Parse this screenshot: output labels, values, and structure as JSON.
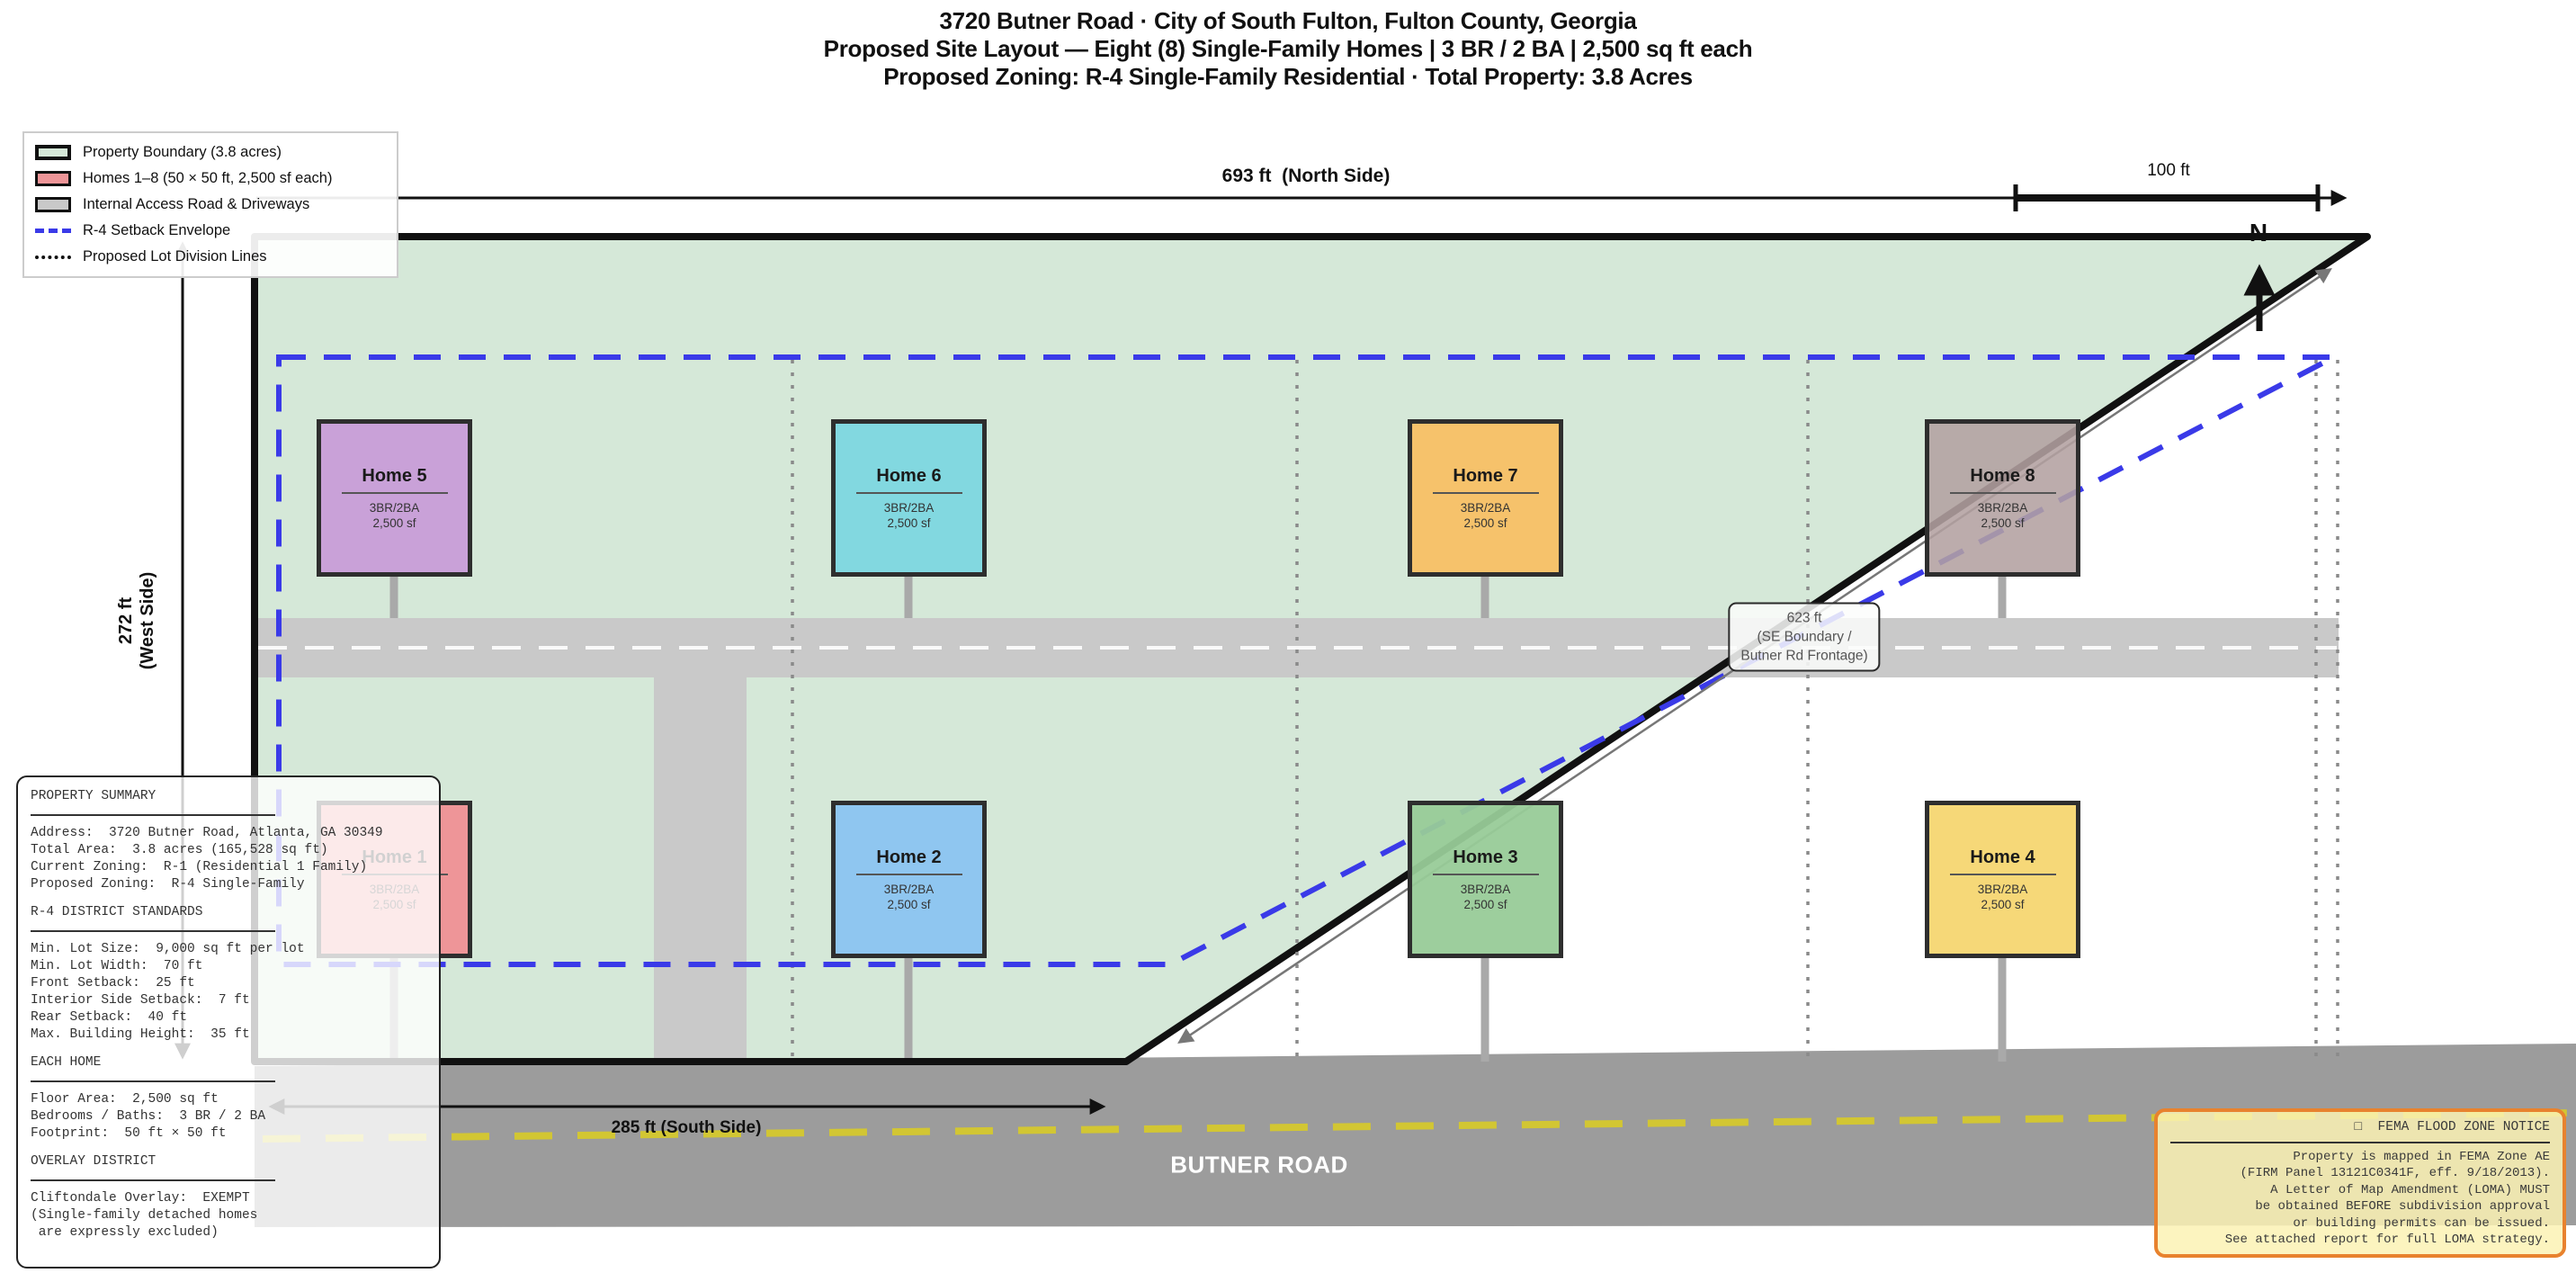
{
  "title": {
    "line1": "3720 Butner Road  ·  City of South Fulton, Fulton County, Georgia",
    "line2": "Proposed Site Layout — Eight (8) Single-Family Homes  |  3 BR / 2 BA  |  2,500 sq ft each",
    "line3": "Proposed Zoning: R-4 Single-Family Residential  ·  Total Property: 3.8 Acres"
  },
  "legend": {
    "items": [
      {
        "swatch": "sw-fill-property",
        "label": "Property Boundary (3.8 acres)"
      },
      {
        "swatch": "sw-fill-homes",
        "label": "Homes 1–8 (50 × 50 ft, 2,500 sf each)"
      },
      {
        "swatch": "sw-fill-road",
        "label": "Internal Access Road & Driveways"
      },
      {
        "swatch": "sw-line-setback",
        "label": "R-4 Setback Envelope"
      },
      {
        "swatch": "sw-line-lot",
        "label": "Proposed Lot Division Lines"
      }
    ]
  },
  "dimensions": {
    "north_label": "693 ft  (North Side)",
    "scale_label": "100 ft",
    "north_arrow_letter": "N",
    "west_label": "272 ft\n(West Side)",
    "south_label": "285 ft (South Side)",
    "se_label_line1": "623 ft",
    "se_label_line2": "(SE Boundary /",
    "se_label_line3": "Butner Rd Frontage)"
  },
  "road_label": "BUTNER ROAD",
  "homes": [
    {
      "name": "Home 1",
      "specs": "3BR/2BA",
      "area": "2,500 sf",
      "color": "#ee9598",
      "slot": "slot-b1"
    },
    {
      "name": "Home 2",
      "specs": "3BR/2BA",
      "area": "2,500 sf",
      "color": "#8fc6f0",
      "slot": "slot-b2"
    },
    {
      "name": "Home 3",
      "specs": "3BR/2BA",
      "area": "2,500 sf",
      "color": "rgba(152,203,152,0.95)",
      "slot": "slot-b3"
    },
    {
      "name": "Home 4",
      "specs": "3BR/2BA",
      "area": "2,500 sf",
      "color": "#f6d878",
      "slot": "slot-b4"
    },
    {
      "name": "Home 5",
      "specs": "3BR/2BA",
      "area": "2,500 sf",
      "color": "#c9a1d8",
      "slot": "slot-t1"
    },
    {
      "name": "Home 6",
      "specs": "3BR/2BA",
      "area": "2,500 sf",
      "color": "#82d8e0",
      "slot": "slot-t2"
    },
    {
      "name": "Home 7",
      "specs": "3BR/2BA",
      "area": "2,500 sf",
      "color": "#f6c26b",
      "slot": "slot-t3"
    },
    {
      "name": "Home 8",
      "specs": "3BR/2BA",
      "area": "2,500 sf",
      "color": "rgba(179,161,161,0.88)",
      "slot": "slot-t4"
    }
  ],
  "summary": {
    "lines": [
      {
        "type": "ln-header",
        "text": "PROPERTY SUMMARY"
      },
      {
        "type": "ln-text",
        "text": "Address:  3720 Butner Road, Atlanta, GA 30349"
      },
      {
        "type": "ln-text",
        "text": "Total Area:  3.8 acres (165,528 sq ft)"
      },
      {
        "type": "ln-text",
        "text": "Current Zoning:  R-1 (Residential 1 Family)"
      },
      {
        "type": "ln-text",
        "text": "Proposed Zoning:  R-4 Single-Family"
      },
      {
        "type": "ln-gap",
        "text": ""
      },
      {
        "type": "ln-header",
        "text": "R-4 DISTRICT STANDARDS"
      },
      {
        "type": "ln-text",
        "text": "Min. Lot Size:  9,000 sq ft per lot"
      },
      {
        "type": "ln-text",
        "text": "Min. Lot Width:  70 ft"
      },
      {
        "type": "ln-text",
        "text": "Front Setback:  25 ft"
      },
      {
        "type": "ln-text",
        "text": "Interior Side Setback:  7 ft"
      },
      {
        "type": "ln-text",
        "text": "Rear Setback:  40 ft"
      },
      {
        "type": "ln-text",
        "text": "Max. Building Height:  35 ft"
      },
      {
        "type": "ln-gap",
        "text": ""
      },
      {
        "type": "ln-header",
        "text": "EACH HOME"
      },
      {
        "type": "ln-text",
        "text": "Floor Area:  2,500 sq ft"
      },
      {
        "type": "ln-text",
        "text": "Bedrooms / Baths:  3 BR / 2 BA"
      },
      {
        "type": "ln-text",
        "text": "Footprint:  50 ft × 50 ft"
      },
      {
        "type": "ln-gap",
        "text": ""
      },
      {
        "type": "ln-header",
        "text": "OVERLAY DISTRICT"
      },
      {
        "type": "ln-text",
        "text": "Cliftondale Overlay:  EXEMPT"
      },
      {
        "type": "ln-text",
        "text": "(Single-family detached homes"
      },
      {
        "type": "ln-text",
        "text": " are expressly excluded)"
      }
    ]
  },
  "fema": {
    "title": "□  FEMA FLOOD ZONE NOTICE",
    "lines": [
      "Property is mapped in FEMA Zone AE",
      "(FIRM Panel 13121C0341F, eff. 9/18/2013).",
      "A Letter of Map Amendment (LOMA) MUST",
      "be obtained BEFORE subdivision approval",
      "or building permits can be issued.",
      "See attached report for full LOMA strategy."
    ]
  },
  "colors": {
    "property_fill": "#d5e8d8",
    "boundary": "#111111",
    "homes_legend": "#ee9598",
    "internal_road": "#c9c9c9",
    "butner_road": "#9c9c9c",
    "setback_blue": "#3a3ae8",
    "centerline_yellow": "#d2c633",
    "centerline_white": "#ffffff",
    "lot_division": "#8a8a8a",
    "fema_border": "#e8822e",
    "fema_bg": "#faf2b4"
  }
}
